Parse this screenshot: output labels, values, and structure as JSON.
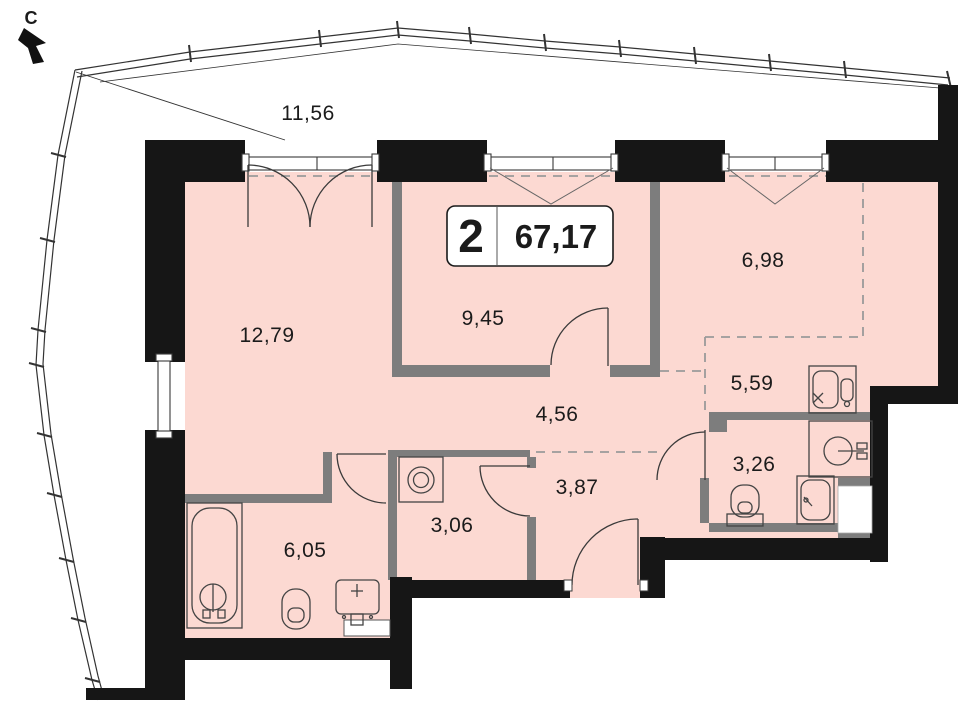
{
  "meta": {
    "type": "apartment-floor-plan"
  },
  "compass": {
    "label": "С"
  },
  "badge": {
    "room_count": "2",
    "total_area": "67,17"
  },
  "balcony": {
    "area": "11,56"
  },
  "rooms": [
    {
      "name": "living-room",
      "area": "12,79"
    },
    {
      "name": "kitchen",
      "area": "9,45"
    },
    {
      "name": "zone-top-right",
      "area": "6,98"
    },
    {
      "name": "zone-right",
      "area": "5,59"
    },
    {
      "name": "hallway",
      "area": "4,56"
    },
    {
      "name": "corridor",
      "area": "3,87"
    },
    {
      "name": "bathroom-small",
      "area": "3,26"
    },
    {
      "name": "laundry",
      "area": "3,06"
    },
    {
      "name": "bathroom-large",
      "area": "6,05"
    }
  ],
  "colors": {
    "room_fill": "#fcd9d2",
    "exterior_wall": "#161616",
    "partition_wall": "#7d7d7d",
    "dashed_line": "#9a9a9a",
    "background": "#ffffff"
  }
}
